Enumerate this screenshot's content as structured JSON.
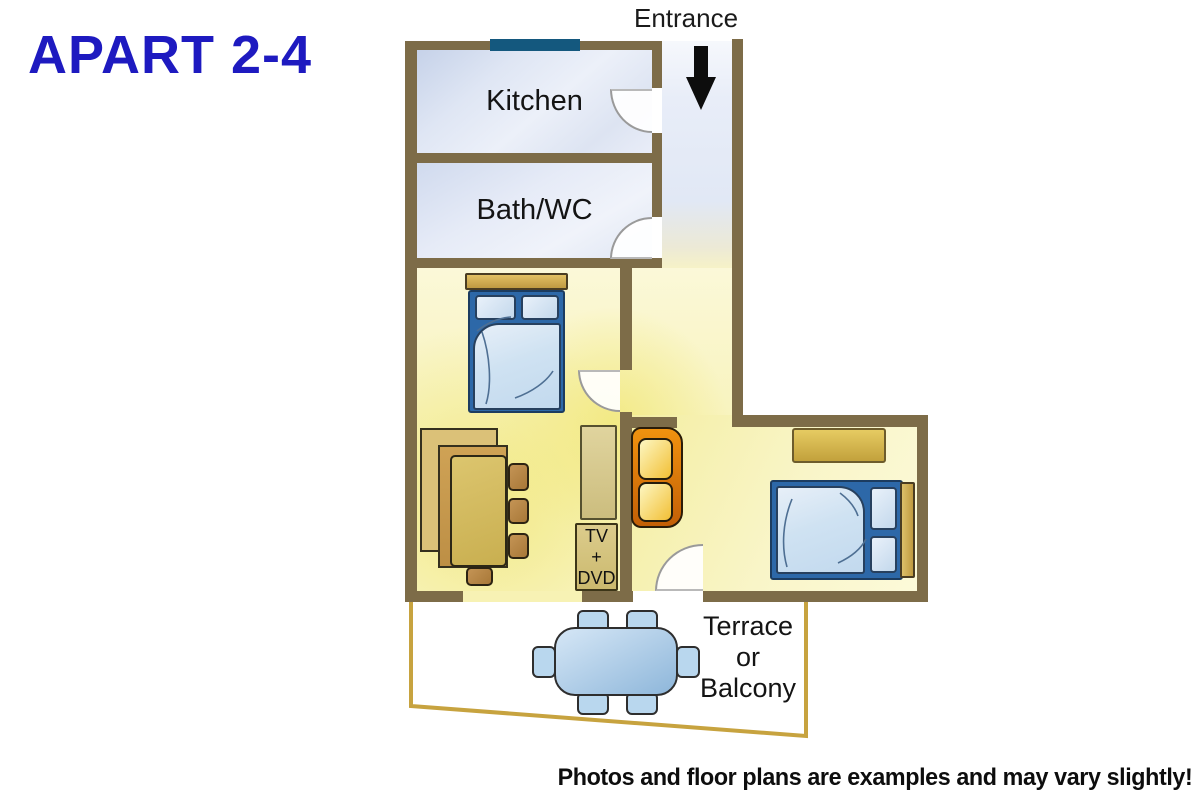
{
  "title": "APART 2-4",
  "entrance": {
    "label": "Entrance"
  },
  "rooms": {
    "kitchen": {
      "label": "Kitchen"
    },
    "bath": {
      "label": "Bath/WC"
    },
    "terrace": {
      "lines": [
        "Terrace",
        "or",
        "Balcony"
      ]
    },
    "living": {
      "label": ""
    },
    "bedroom": {
      "label": ""
    }
  },
  "furniture": {
    "tv_unit": {
      "lines": [
        "TV",
        "+",
        "DVD"
      ]
    }
  },
  "footer": {
    "disclaimer": "Photos and floor plans are examples and may vary slightly!"
  },
  "colors": {
    "title_blue": "#1e1ac0",
    "wall_brown": "#7d6c48",
    "window_teal": "#14587e",
    "floor_yellow": "#f7f2b6",
    "floor_blue": "#e3e9f5",
    "bed_frame_blue": "#2d68a8",
    "bedding_blue": "#cfe2f2",
    "sofa_orange": "#e07a0a",
    "cushion_gold": "#f2bf35",
    "wood_tan": "#cdb258",
    "terrace_border_gold": "#c7a33f",
    "terrace_table_blue": "#a9cbe8",
    "arrow_black": "#0d0d0d",
    "text_black": "#141414"
  }
}
